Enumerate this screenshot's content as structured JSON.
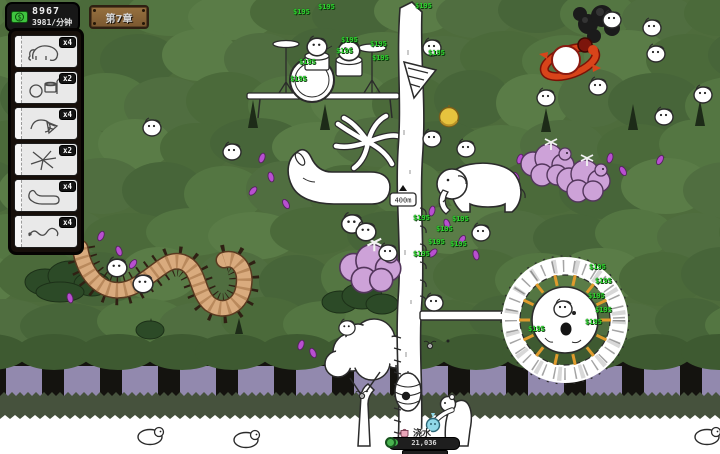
{
  "hud": {
    "money": {
      "amount": "8967",
      "rate": "3981/分钟"
    },
    "chapter": {
      "label": "第7章"
    }
  },
  "panel": {
    "items": [
      {
        "name": "elephant-card",
        "count": "x4"
      },
      {
        "name": "drum-kit-card",
        "count": "x2"
      },
      {
        "name": "drill-creature-card",
        "count": "x4"
      },
      {
        "name": "splat-creature-card",
        "count": "x2"
      },
      {
        "name": "sock-creature-card",
        "count": "x4"
      },
      {
        "name": "snake-creature-card",
        "count": "x4"
      }
    ]
  },
  "tower": {
    "height_sign": "400m"
  },
  "action": {
    "label": "浇水",
    "progress": "21,036"
  },
  "floating": {
    "gain": "$195"
  },
  "icons": [
    "money-bill-icon",
    "watering-can-icon"
  ],
  "colors": {
    "gain_green": "#2ed32e",
    "hud_money_green": "#3fc43f",
    "wood_brown": "#8a6134",
    "canopy_green": "#4e6c3c",
    "cloud_pink": "#cda2d8",
    "petal_magenta": "#b84fd0",
    "centipede_tan": "#d9ab7e",
    "ray_orange": "#e09b2d",
    "flame_red": "#d8441a",
    "purple_gap": "#9289ae",
    "progress_green": "#3fae49"
  }
}
